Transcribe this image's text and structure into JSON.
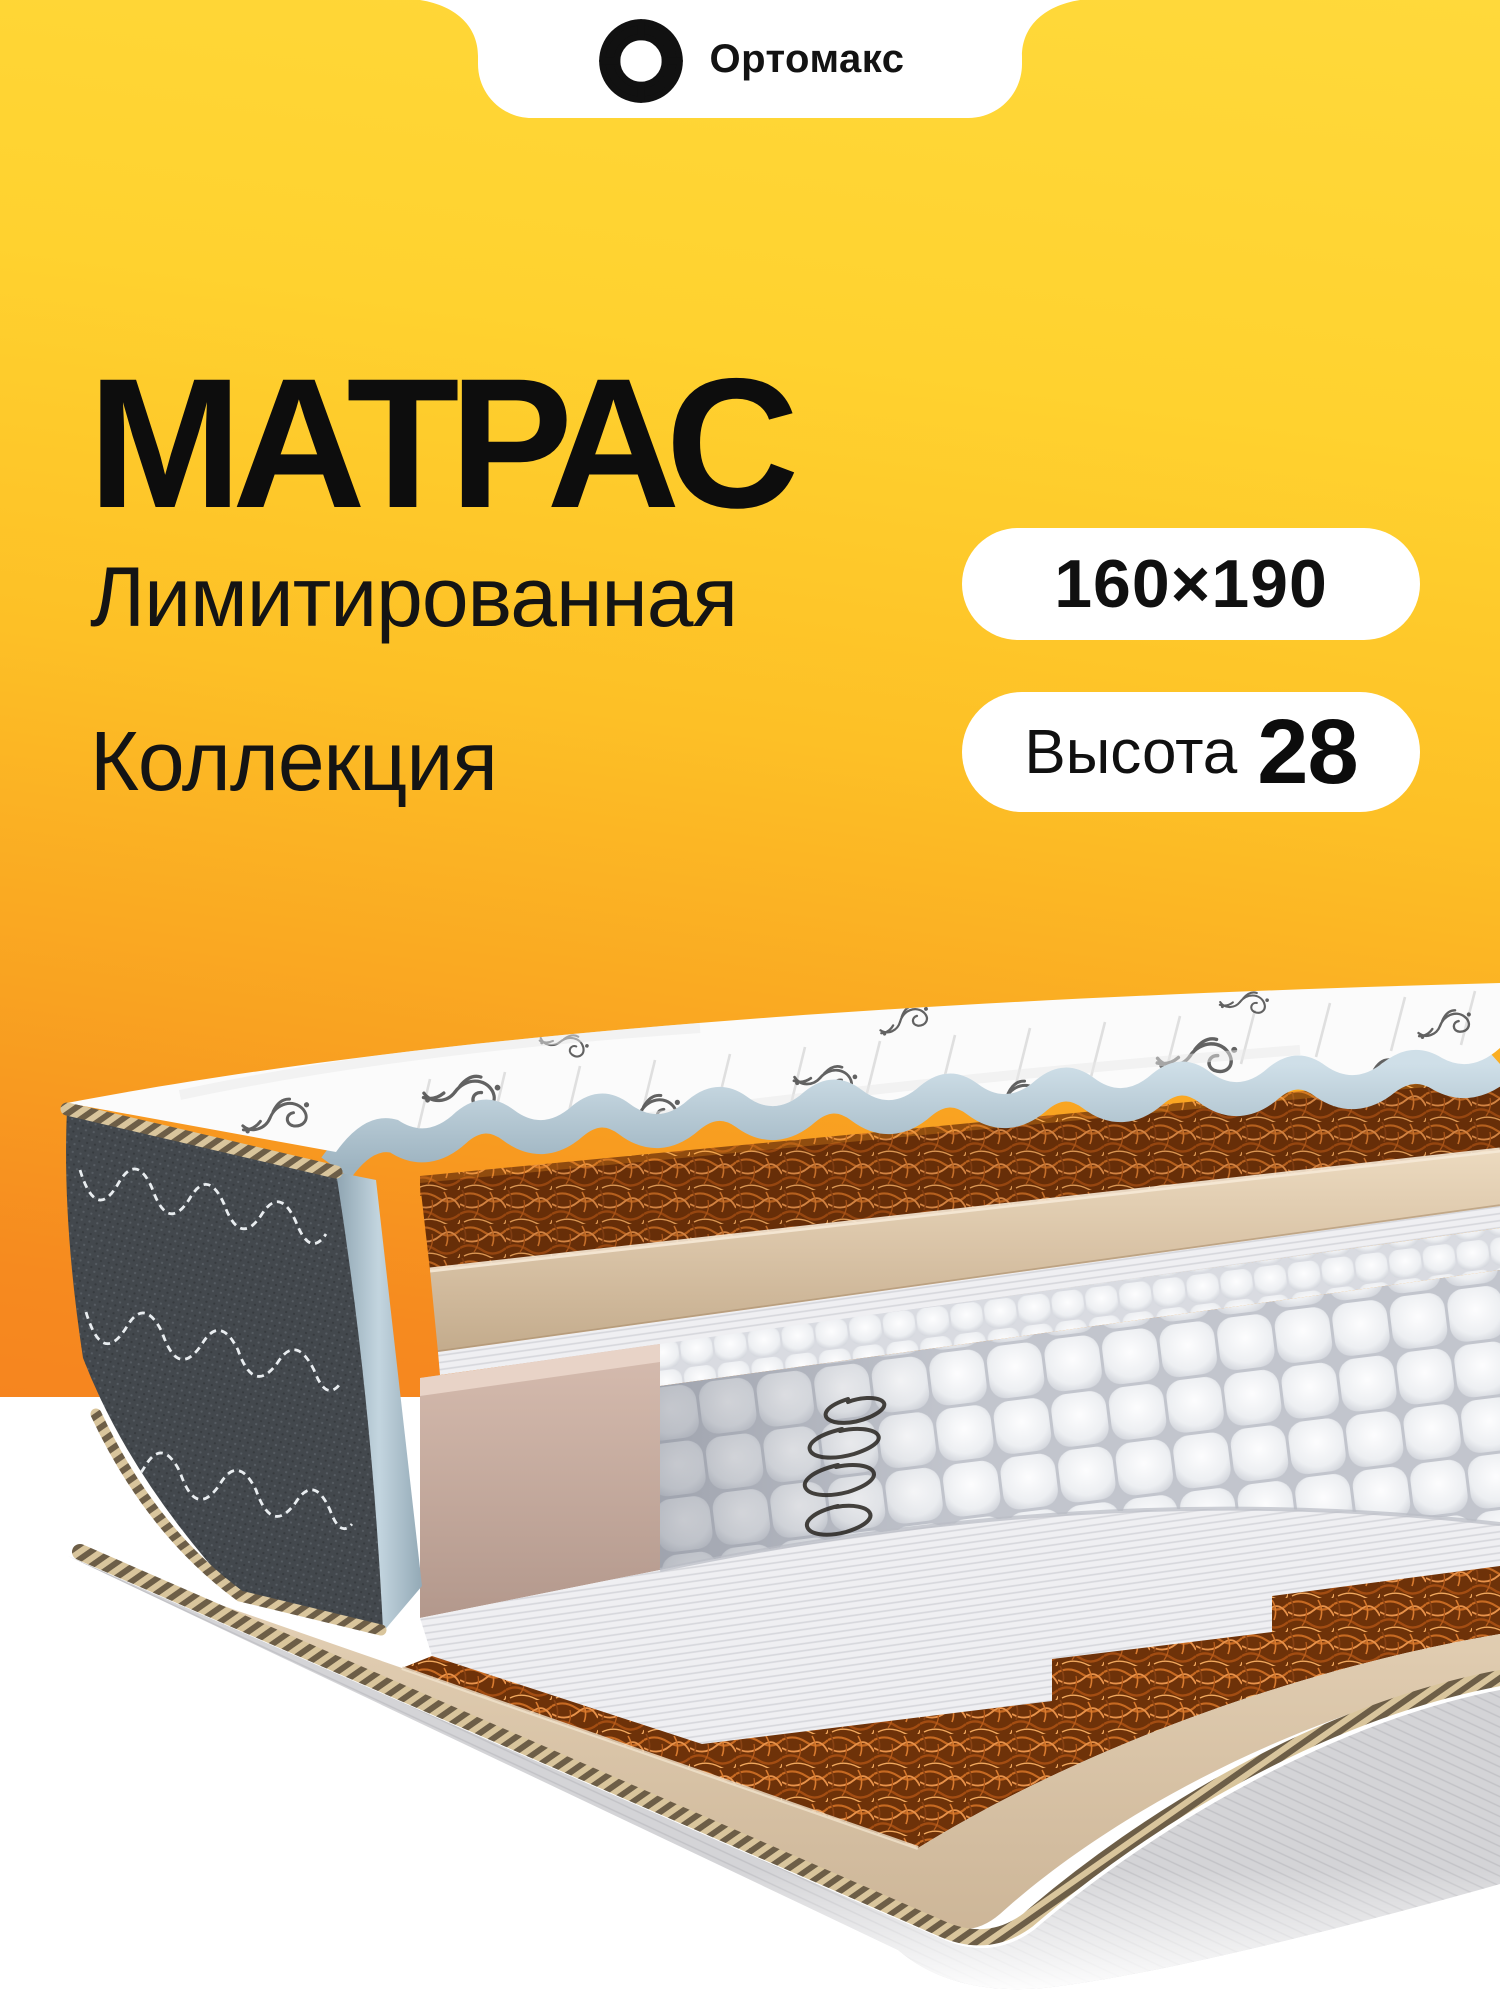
{
  "brand": {
    "name": "Ортомакс",
    "logo_icon": "shutter-swirl-icon"
  },
  "title": "МАТРАС",
  "subtitle": {
    "line1": "Лимитированная",
    "line2": "Коллекция"
  },
  "badges": {
    "size": {
      "value": "160×190"
    },
    "height": {
      "label": "Высота",
      "value": "28"
    }
  },
  "photo": {
    "subject": "mattress-cutaway",
    "layers": [
      "quilted-floral-top-cover",
      "scalloped-blue-edge-trim",
      "coconut-coir-top-layer",
      "beige-foam-layer",
      "felt-spunbond-sheet",
      "pocket-spring-block",
      "spring-coil-sketch",
      "side-foam-wall",
      "lower-coir-layer",
      "base-foam-layer",
      "rope-piping-cord",
      "grey-bottom-cover",
      "quilted-side-flap",
      "blue-flap-lining"
    ]
  },
  "colors": {
    "background_top": "#FFD93B",
    "background_mid": "#FBB424",
    "background_bottom": "#F6851F",
    "panel": "#FFFFFF",
    "text": "#111111",
    "coir": "#B65A1D",
    "foam": "#DCC6AA",
    "springs": "#EDEFF2",
    "flap": "#43484D",
    "trim_blue": "#BCCFDA",
    "pink_foam": "#C9AEA2"
  }
}
